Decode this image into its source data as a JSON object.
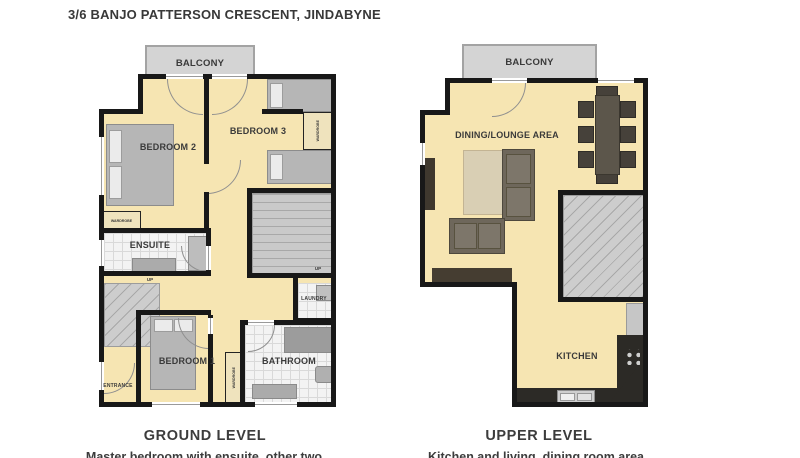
{
  "title": "3/6 BANJO PATTERSON CRESCENT, JINDABYNE",
  "ground": {
    "heading": "GROUND LEVEL",
    "caption": "Master bedroom with ensuite, other two",
    "labels": {
      "balcony": "BALCONY",
      "bedroom2": "BEDROOM 2",
      "bedroom3": "BEDROOM 3",
      "ensuite": "ENSUITE",
      "bedroom1": "BEDROOM 1",
      "bathroom": "BATHROOM",
      "laundry": "LAUNDRY",
      "entrance": "ENTRANCE",
      "wardrobe": "WARDROBE",
      "up": "UP"
    }
  },
  "upper": {
    "heading": "UPPER LEVEL",
    "caption": "Kitchen and living, dining room area",
    "labels": {
      "balcony": "BALCONY",
      "dining_lounge": "DINING/LOUNGE AREA",
      "kitchen": "KITCHEN"
    }
  },
  "colors": {
    "floor": "#f6e5b2",
    "balcony": "#d4d4d4",
    "wall": "#181818",
    "tile": "#f3f3f3",
    "furniture_gray": "#b6b6b6",
    "sofa_brown": "#6e675b",
    "counter_dark": "#2c2a26",
    "rug": "#d9cfb4",
    "text": "#3c3c3c"
  }
}
